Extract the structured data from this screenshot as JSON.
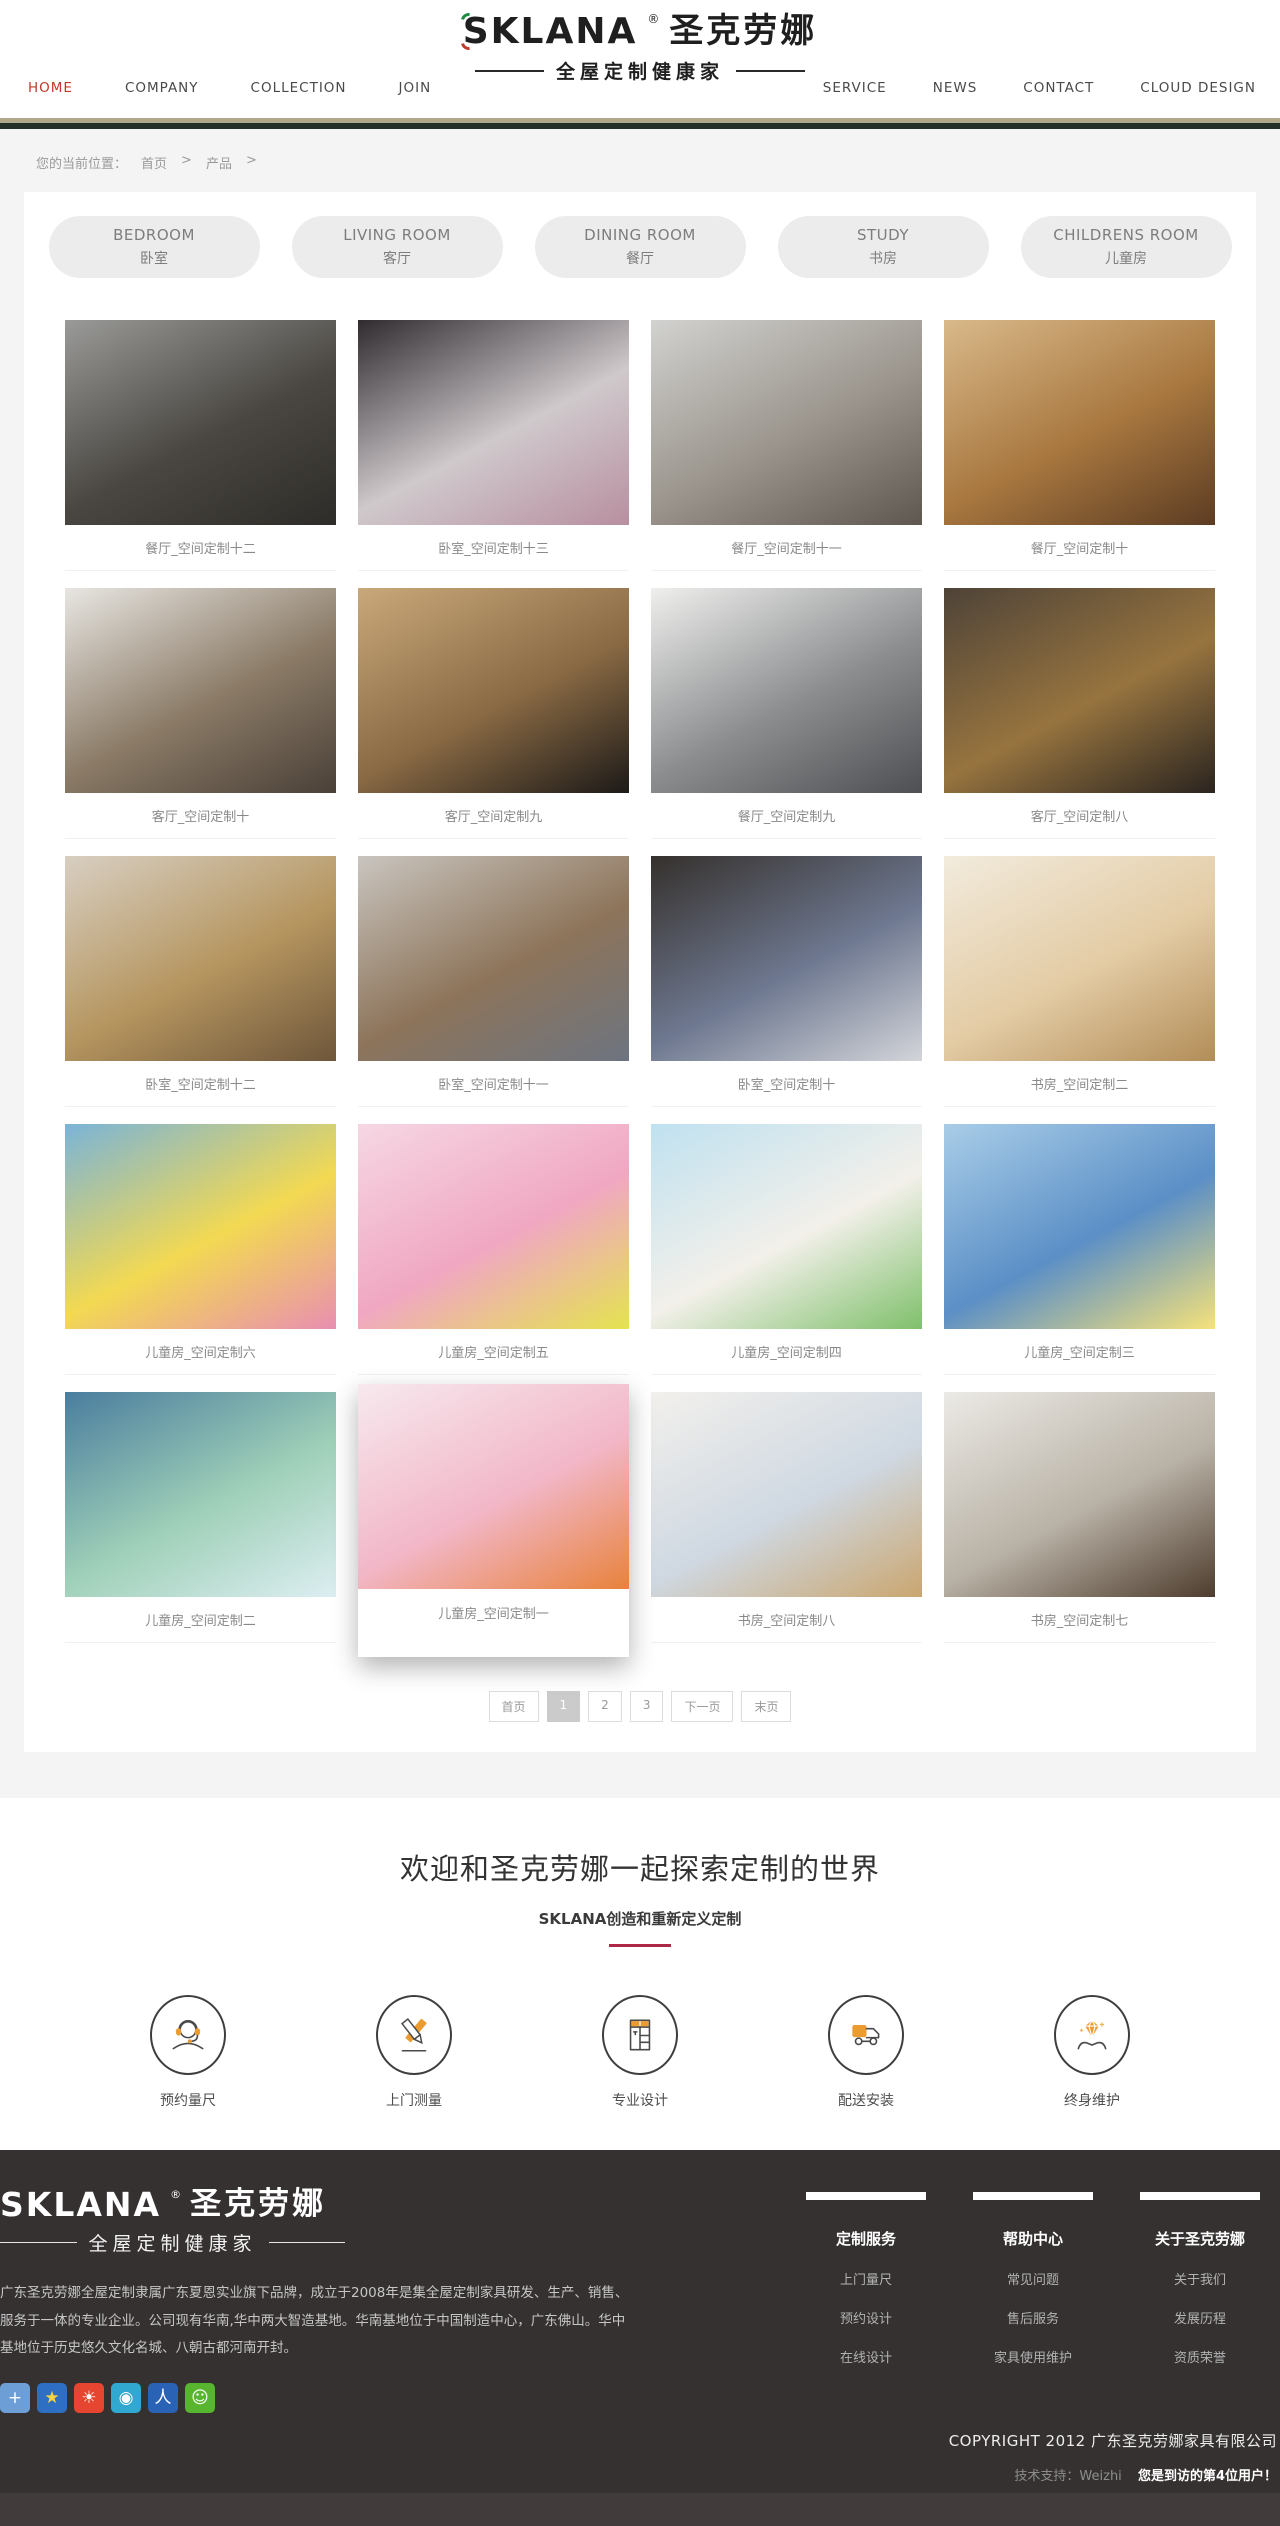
{
  "brand": {
    "logo_text": "SKLANA",
    "logo_reg": "®",
    "logo_cn": "圣克劳娜",
    "logo_tagline": "全屋定制健康家"
  },
  "nav": {
    "left": [
      {
        "label": "HOME",
        "active": true
      },
      {
        "label": "COMPANY"
      },
      {
        "label": "COLLECTION"
      },
      {
        "label": "JOIN"
      }
    ],
    "right": [
      {
        "label": "SERVICE"
      },
      {
        "label": "NEWS"
      },
      {
        "label": "CONTACT"
      },
      {
        "label": "CLOUD DESIGN"
      }
    ],
    "active_color": "#c0392b"
  },
  "breadcrumb": {
    "prefix": "您的当前位置：",
    "home": "首页",
    "sep1": ">",
    "current": "产品",
    "sep2": ">"
  },
  "categories": [
    {
      "en": "BEDROOM",
      "zh": "卧室"
    },
    {
      "en": "LIVING ROOM",
      "zh": "客厅"
    },
    {
      "en": "DINING ROOM",
      "zh": "餐厅"
    },
    {
      "en": "STUDY",
      "zh": "书房"
    },
    {
      "en": "CHILDRENS ROOM",
      "zh": "儿童房"
    }
  ],
  "products": [
    {
      "title": "餐厅_空间定制十二",
      "colors": [
        "#9a9a98",
        "#4a4742",
        "#2e2c28"
      ]
    },
    {
      "title": "卧室_空间定制十三",
      "colors": [
        "#2f2b2e",
        "#cfc9cc",
        "#b88fa0"
      ]
    },
    {
      "title": "餐厅_空间定制十一",
      "colors": [
        "#d2d2d0",
        "#9a948c",
        "#5e5750"
      ]
    },
    {
      "title": "餐厅_空间定制十",
      "colors": [
        "#d9b98a",
        "#a8773f",
        "#5c3c22"
      ]
    },
    {
      "title": "客厅_空间定制十",
      "colors": [
        "#e8e6e2",
        "#8a7a66",
        "#4a4038"
      ]
    },
    {
      "title": "客厅_空间定制九",
      "colors": [
        "#c9a97a",
        "#8a6a44",
        "#1d1a18"
      ]
    },
    {
      "title": "餐厅_空间定制九",
      "colors": [
        "#efefed",
        "#8b8d8f",
        "#4d4f52"
      ]
    },
    {
      "title": "客厅_空间定制八",
      "colors": [
        "#4e4338",
        "#97743f",
        "#2a241f"
      ]
    },
    {
      "title": "卧室_空间定制十二",
      "colors": [
        "#d8cfc2",
        "#b5955f",
        "#6e563a"
      ]
    },
    {
      "title": "卧室_空间定制十一",
      "colors": [
        "#c9c5bf",
        "#8d745a",
        "#6d7480"
      ]
    },
    {
      "title": "卧室_空间定制十",
      "colors": [
        "#35302c",
        "#6e7890",
        "#d3d5da"
      ]
    },
    {
      "title": "书房_空间定制二",
      "colors": [
        "#f2ebdd",
        "#e3cba4",
        "#b28d58"
      ]
    },
    {
      "title": "儿童房_空间定制六",
      "colors": [
        "#7ab4d8",
        "#f2d952",
        "#e98fb1"
      ]
    },
    {
      "title": "儿童房_空间定制五",
      "colors": [
        "#f6d7e4",
        "#f0a7c2",
        "#e4e34f"
      ]
    },
    {
      "title": "儿童房_空间定制四",
      "colors": [
        "#bfe1f0",
        "#f3f0ea",
        "#7fc06b"
      ]
    },
    {
      "title": "儿童房_空间定制三",
      "colors": [
        "#a9cde8",
        "#5b8fc6",
        "#f5e27a"
      ]
    },
    {
      "title": "儿童房_空间定制二",
      "colors": [
        "#4a7d9e",
        "#9fd0b8",
        "#ddeef2"
      ]
    },
    {
      "title": "儿童房_空间定制一",
      "colors": [
        "#f7e9ee",
        "#f2b7c8",
        "#e8823c"
      ],
      "hover": true
    },
    {
      "title": "书房_空间定制八",
      "colors": [
        "#f2f0ec",
        "#cfd8e2",
        "#caa66f"
      ]
    },
    {
      "title": "书房_空间定制七",
      "colors": [
        "#eceae6",
        "#b9b2a6",
        "#4e3d2e"
      ]
    }
  ],
  "pagination": [
    {
      "label": "首页"
    },
    {
      "label": "1",
      "active": true
    },
    {
      "label": "2"
    },
    {
      "label": "3"
    },
    {
      "label": "下一页"
    },
    {
      "label": "末页"
    }
  ],
  "welcome": {
    "title": "欢迎和圣克劳娜一起探索定制的世界",
    "subtitle": "SKLANA创造和重新定义定制",
    "accent_color": "#ad2746"
  },
  "services": [
    {
      "icon": "headset-icon",
      "label": "预约量尺"
    },
    {
      "icon": "measure-icon",
      "label": "上门测量"
    },
    {
      "icon": "wardrobe-icon",
      "label": "专业设计"
    },
    {
      "icon": "truck-icon",
      "label": "配送安装"
    },
    {
      "icon": "diamond-hands-icon",
      "label": "终身维护"
    }
  ],
  "footer": {
    "description": "广东圣克劳娜全屋定制隶属广东夏恩实业旗下品牌，成立于2008年是集全屋定制家具研发、生产、销售、服务于一体的专业企业。公司现有华南,华中两大智造基地。华南基地位于中国制造中心，广东佛山。华中基地位于历史悠久文化名城、八朝古都河南开封。",
    "columns": [
      {
        "heading": "定制服务",
        "links": [
          "上门量尺",
          "预约设计",
          "在线设计"
        ]
      },
      {
        "heading": "帮助中心",
        "links": [
          "常见问题",
          "售后服务",
          "家具使用维护"
        ]
      },
      {
        "heading": "关于圣克劳娜",
        "links": [
          "关于我们",
          "发展历程",
          "资质荣誉"
        ]
      }
    ],
    "social": [
      {
        "name": "share-plus-icon",
        "bg": "#6d9ed6",
        "glyph": "+",
        "fg": "#ffffff"
      },
      {
        "name": "qzone-icon",
        "bg": "#2e6fc3",
        "glyph": "★",
        "fg": "#f7d442"
      },
      {
        "name": "sina-weibo-icon",
        "bg": "#e6452f",
        "glyph": "☀",
        "fg": "#ffffff"
      },
      {
        "name": "tencent-weibo-icon",
        "bg": "#31a8cf",
        "glyph": "◉",
        "fg": "#ffffff"
      },
      {
        "name": "renren-icon",
        "bg": "#2a62b5",
        "glyph": "人",
        "fg": "#ffffff"
      },
      {
        "name": "wechat-icon",
        "bg": "#58b530",
        "glyph": "☺",
        "fg": "#ffffff"
      }
    ],
    "copyright": "COPYRIGHT 2012 广东圣克劳娜家具有限公司",
    "support_label": "技术支持：Weizhi",
    "visitor_note": "您是到访的第4位用户！"
  }
}
